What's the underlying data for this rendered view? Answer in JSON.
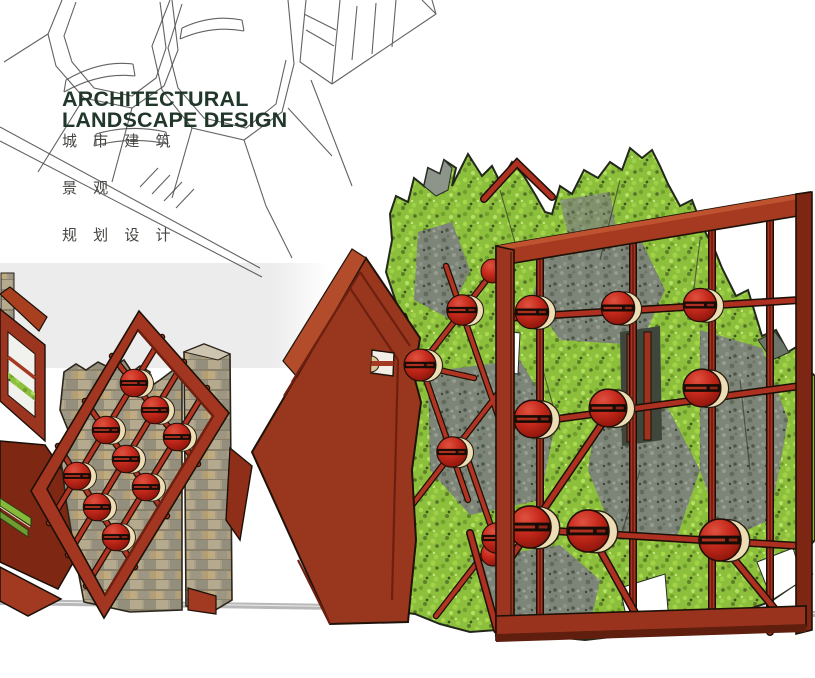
{
  "artwork": {
    "title_line1": "ARCHITECTURAL",
    "title_line2": "LANDSCAPE DESIGN",
    "subtitle_cn": [
      "城 市 建 筑",
      "景 观",
      "规 划 设 计"
    ]
  },
  "palette": {
    "background": "#ffffff",
    "backdrop_band": "#ececec",
    "title_green": "#20372a",
    "subtitle_gray": "#454542",
    "sketch_line": "#474747",
    "corten_red": "#9a371f",
    "lattice_red": "#b23524",
    "sphere_red": "#c62a1c",
    "sphere_rim_cream": "#ecddb4",
    "moss_green": "#8cbf3b",
    "rock_gray": "#7d8578",
    "stone_tan": "#a79e88",
    "ground_line_gray": "#b8b8b8"
  }
}
